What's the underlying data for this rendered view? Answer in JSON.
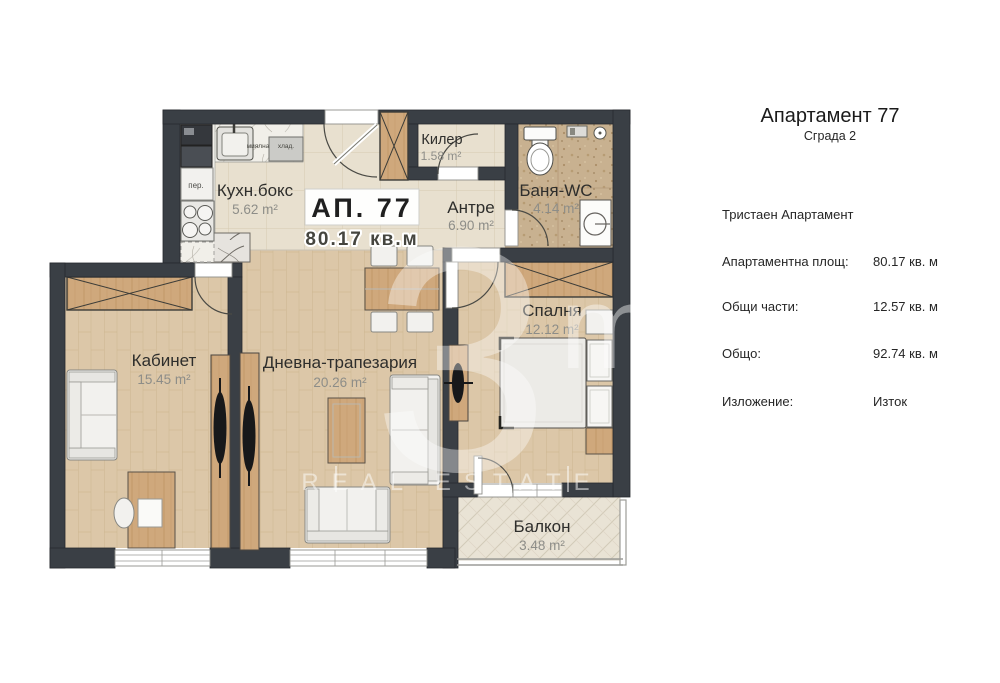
{
  "panel": {
    "title": "Апартамент 77",
    "subtitle": "Сграда 2",
    "apartment_type": "Тристаен Апартамент",
    "rows": [
      {
        "label": "Апартаментна площ:",
        "value": "80.17 кв. м"
      },
      {
        "label": "Общи части:",
        "value": "12.57 кв. м"
      },
      {
        "label": "Общо:",
        "value": "92.74 кв. м"
      },
      {
        "label": "Изложение:",
        "value": "Изток"
      }
    ]
  },
  "plan": {
    "card": {
      "name": "АП. 77",
      "area": "80.17 кв.м"
    },
    "rooms": [
      {
        "name": "Кухн.бокс",
        "area": "5.62 m²"
      },
      {
        "name": "Килер",
        "area": "1.58 m²"
      },
      {
        "name": "Баня-WC",
        "area": "4.14 m²"
      },
      {
        "name": "Антре",
        "area": "6.90 m²"
      },
      {
        "name": "Кабинет",
        "area": "15.45 m²"
      },
      {
        "name": "Дневна-трапезария",
        "area": "20.26 m²"
      },
      {
        "name": "Спалня",
        "area": "12.12 m²"
      },
      {
        "name": "Балкон",
        "area": "3.48 m²"
      }
    ],
    "appliances": {
      "washer": "пер.",
      "dishwasher": "миялна",
      "fridge": "хлад."
    },
    "watermark": {
      "big": "3",
      "small": "mo",
      "caption": "REAL ESTATE"
    },
    "colors": {
      "wall": "#3a3f45",
      "wood_floor": "#dcc7a8",
      "tile_floor": "#e8e0cf",
      "bath_tile": "#c8b190",
      "balcony_floor": "#e9e3d5",
      "cabinet_wood": "#cfa87c"
    }
  }
}
